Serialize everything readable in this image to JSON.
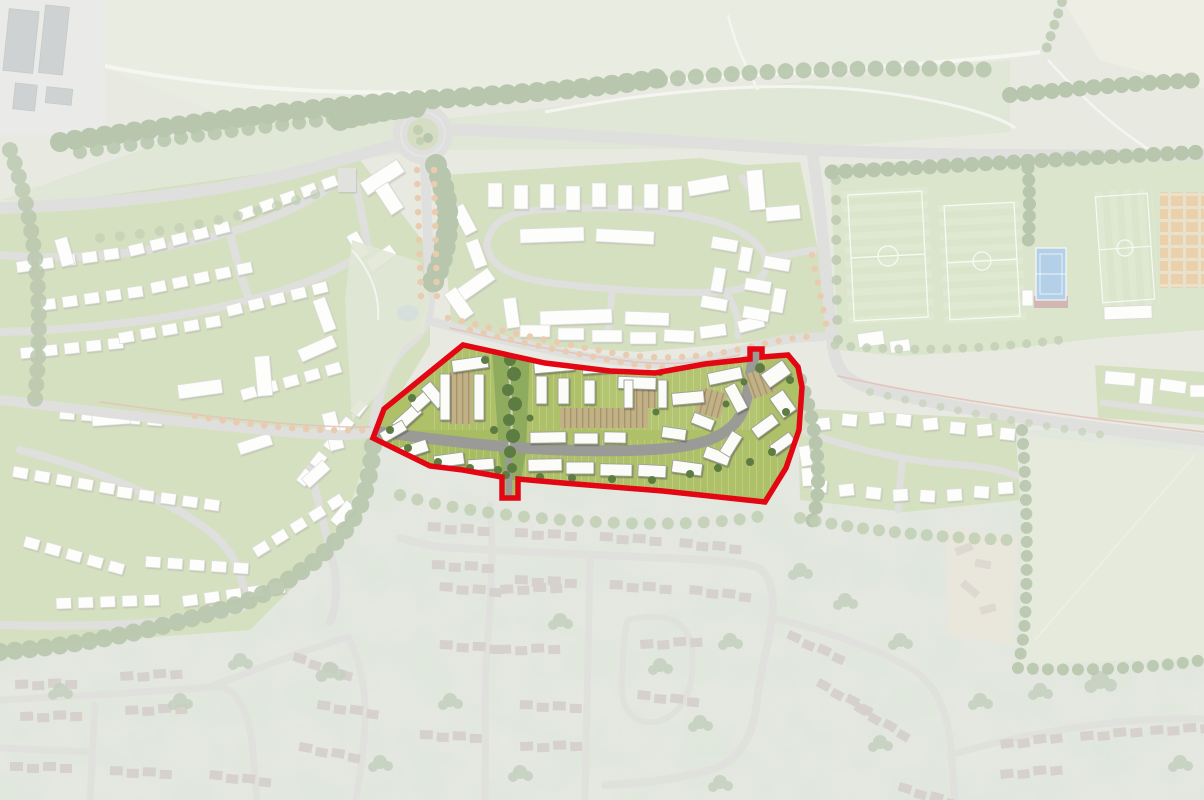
{
  "map": {
    "type": "masterplan-site-location-aerial",
    "description": "Illustrative masterplan aerial view; proposed development parcel outlined in red at full colour, surrounding context (new neighbourhoods, sports grounds, fields and existing village aerial photo) faded with a white wash. No text labels are rendered in the image.",
    "site": {
      "boundary_color": "#e30613",
      "boundary_width": 5.5,
      "access_points": [
        "west-avenue-entrance",
        "north-east-street-exit",
        "south-pedestrian-link"
      ]
    },
    "fade": {
      "overlay_color": "#ffffff",
      "opacity": "0.57"
    },
    "counts": {
      "football_pitches": 3,
      "tennis_courts": 1,
      "roundabouts": 1
    },
    "colors": {
      "base": "#c9cfbc",
      "photo_ground": "#c6cabb",
      "photo_road": "#b8bab1",
      "photo_roof": "#a1948a",
      "road": "#b4b6b0",
      "site_road": "#9a9a96",
      "estate_green": "#9fb86d",
      "site_green": "#aec169",
      "corridor_green": "#8fab5e",
      "building": "#fbfbf8",
      "building_stroke": "#9f9f98",
      "tree_dark": "#5c7c42",
      "tree_mid": "#6f9050",
      "street_tree_orange": "#cc8a45",
      "sports_grass": "#a9c288",
      "pitch_line": "#edf2e6",
      "tennis_blue": "#4f93c9",
      "tennis_surround": "#95564a",
      "allotment_plot": "#cf9440",
      "parking": "#c2b186",
      "field_beige": "#d9d7c4",
      "field_green": "#c3cfae",
      "park_grass": "#b9c7a0",
      "pond": "#9fb4ad",
      "cycleway": "#c0705a",
      "industrial_shed": "#8f969a"
    },
    "features": [
      {
        "name": "site-boundary",
        "desc": "thick red outline around proposed parcel"
      },
      {
        "name": "site-masterplan",
        "desc": "full-colour blocks, gardens, parking courts, green corridor"
      },
      {
        "name": "roundabout",
        "desc": "grass-centred roundabout top left"
      },
      {
        "name": "avenue-street-trees",
        "desc": "orange street trees along boulevard"
      },
      {
        "name": "west-neighbourhood",
        "desc": "faded masterplan housing west"
      },
      {
        "name": "north-neighbourhood",
        "desc": "faded masterplan housing north of site"
      },
      {
        "name": "east-cul-de-sac",
        "desc": "faded housing east of site"
      },
      {
        "name": "sports-grounds",
        "desc": "football pitches, tennis court, allotments, pavilion"
      },
      {
        "name": "existing-village",
        "desc": "faded aerial photograph housing to the south"
      },
      {
        "name": "farm-fields",
        "desc": "open fields east and north"
      },
      {
        "name": "industrial-yard",
        "desc": "sheds top-left corner"
      }
    ]
  }
}
